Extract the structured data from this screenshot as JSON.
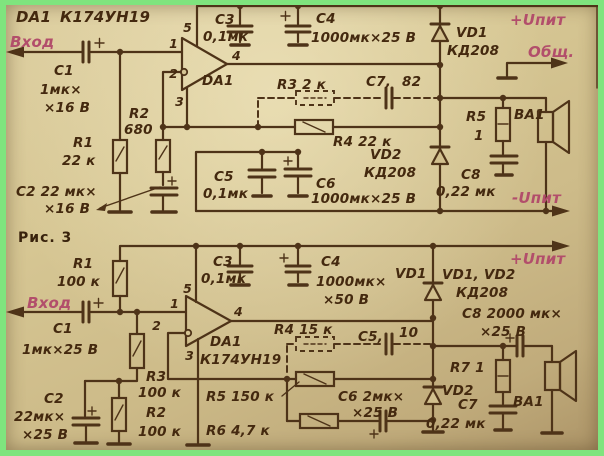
{
  "caption": "Рис. 3",
  "fig1": {
    "title_ref": "DA1",
    "title_part": "К174УН19",
    "input_label": "Вход",
    "rail_pos": "+Uпит",
    "rail_common": "Общ.",
    "rail_neg": "-Uпит",
    "c1": "C1",
    "c1_val": "1мк×",
    "c1_val2": "×16 В",
    "r1": "R1",
    "r1_val": "22 к",
    "c2_val": "C2  22 мк×",
    "c2_val2": "×16 В",
    "r2": "R2",
    "r2_val": "680",
    "opamp": "DA1",
    "pin1": "1",
    "pin2": "2",
    "pin3": "3",
    "pin4": "4",
    "pin5": "5",
    "c3": "C3",
    "c3_val": "0,1мк",
    "c4": "C4",
    "c4_val": "1000мк×25 В",
    "vd1": "VD1",
    "vd1_type": "КД208",
    "r3_val": "R3  2 к",
    "c7_label": "C7,",
    "c7_val": "82",
    "r4_val": "R4  22 к",
    "c5": "C5",
    "c5_val": "0,1мк",
    "c6": "C6",
    "c6_val": "1000мк×25 В",
    "vd2": "VD2",
    "vd2_type": "КД208",
    "r5": "R5",
    "r5_val": "1",
    "ba1": "BA1",
    "c8": "C8",
    "c8_val": "0,22 мк"
  },
  "fig2": {
    "input_label": "Вход",
    "rail_pos": "+Uпит",
    "r1": "R1",
    "r1_val": "100 к",
    "c1": "C1",
    "c1_val": "1мк×25 В",
    "c2": "C2",
    "c2_val": "22мк×",
    "c2_val2": "×25 В",
    "r3": "R3",
    "r3_val": "100 к",
    "r2": "R2",
    "r2_val": "100 к",
    "opamp_ref": "DA1",
    "opamp_part": "К174УН19",
    "pin1": "1",
    "pin2": "2",
    "pin3": "3",
    "pin4": "4",
    "pin5": "5",
    "c3": "C3",
    "c3_val": "0,1мк",
    "c4": "C4",
    "c4_val": "1000мк×",
    "c4_val2": "×50 В",
    "vd1": "VD1",
    "vd_pair": "VD1, VD2",
    "vd_type": "КД208",
    "r4_val": "R4  15 к",
    "c5_label": "C5,",
    "c5_val": "10",
    "c8_val": "C8  2000 мк×",
    "c8_val2": "×25 В",
    "r5_val": "R5  150 к",
    "r6_val": "R6  4,7 к",
    "c6_val": "C6  2мк×",
    "c6_val2": "×25 В",
    "vd2": "VD2",
    "c7": "C7",
    "c7_val": "0,22 мк",
    "r7_val": "R7 1",
    "ba1": "BA1"
  }
}
